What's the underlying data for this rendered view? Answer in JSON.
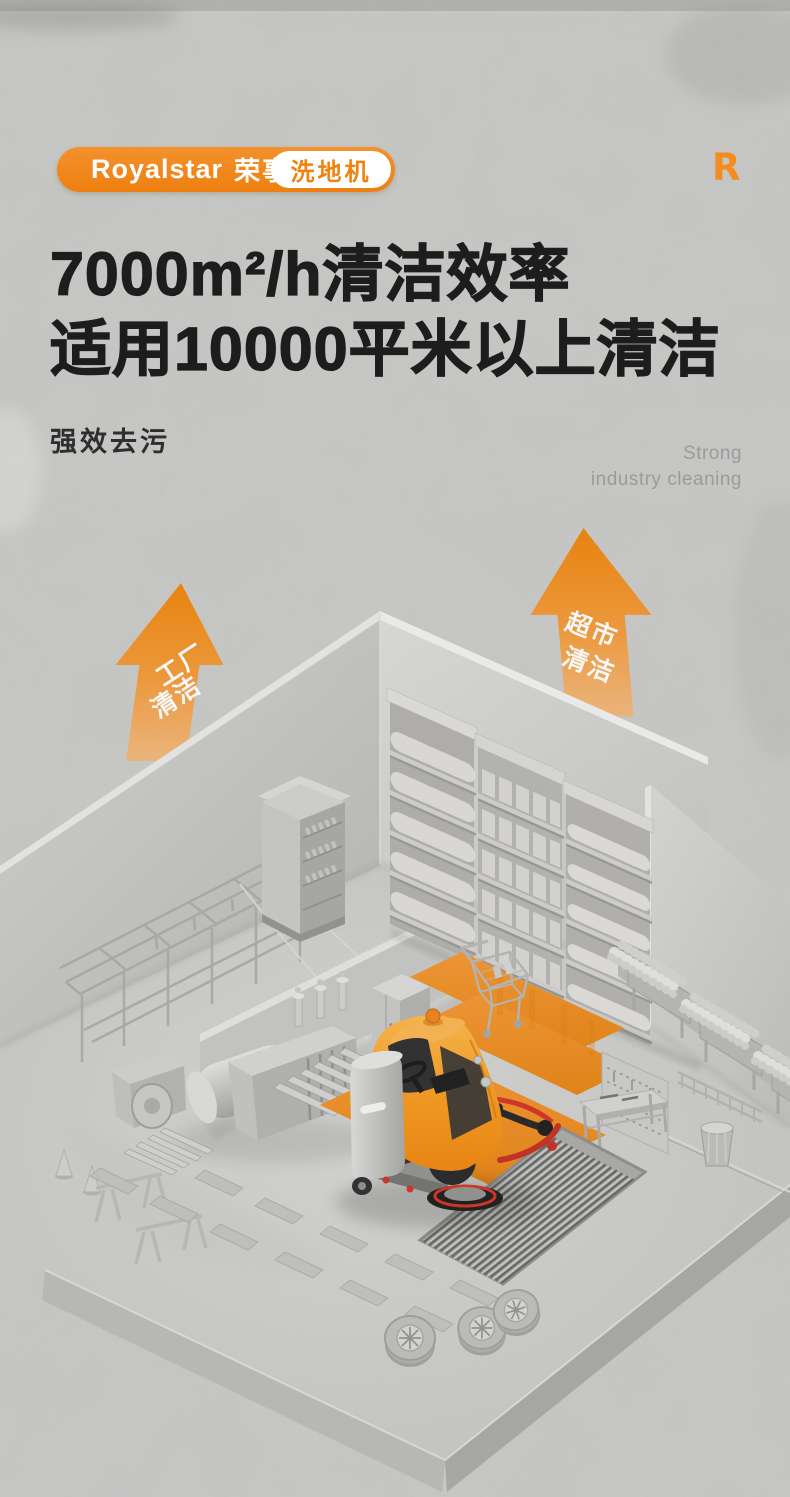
{
  "brand": {
    "name_en": "Royalstar",
    "name_cn": "荣事达",
    "tag": "洗地机",
    "watermark": "R"
  },
  "headline": {
    "line1": "7000m²/h清洁效率",
    "line2": "适用10000平米以上清洁"
  },
  "subhead": {
    "cn": "强效去污",
    "en_line1": "Strong",
    "en_line2": "industry cleaning"
  },
  "arrows": {
    "factory": {
      "line1": "工厂",
      "line2": "清洁"
    },
    "supermarket": {
      "line1": "超市",
      "line2": "清洁"
    }
  },
  "colors": {
    "accent": "#F0861A",
    "accent_dark": "#ED7D00",
    "arrow_light": "#F7B169",
    "floor_orange": "#EF8C1A",
    "headline": "#1D1D1D",
    "muted_text": "#9B9B9B",
    "background": "#CBCBC9"
  }
}
